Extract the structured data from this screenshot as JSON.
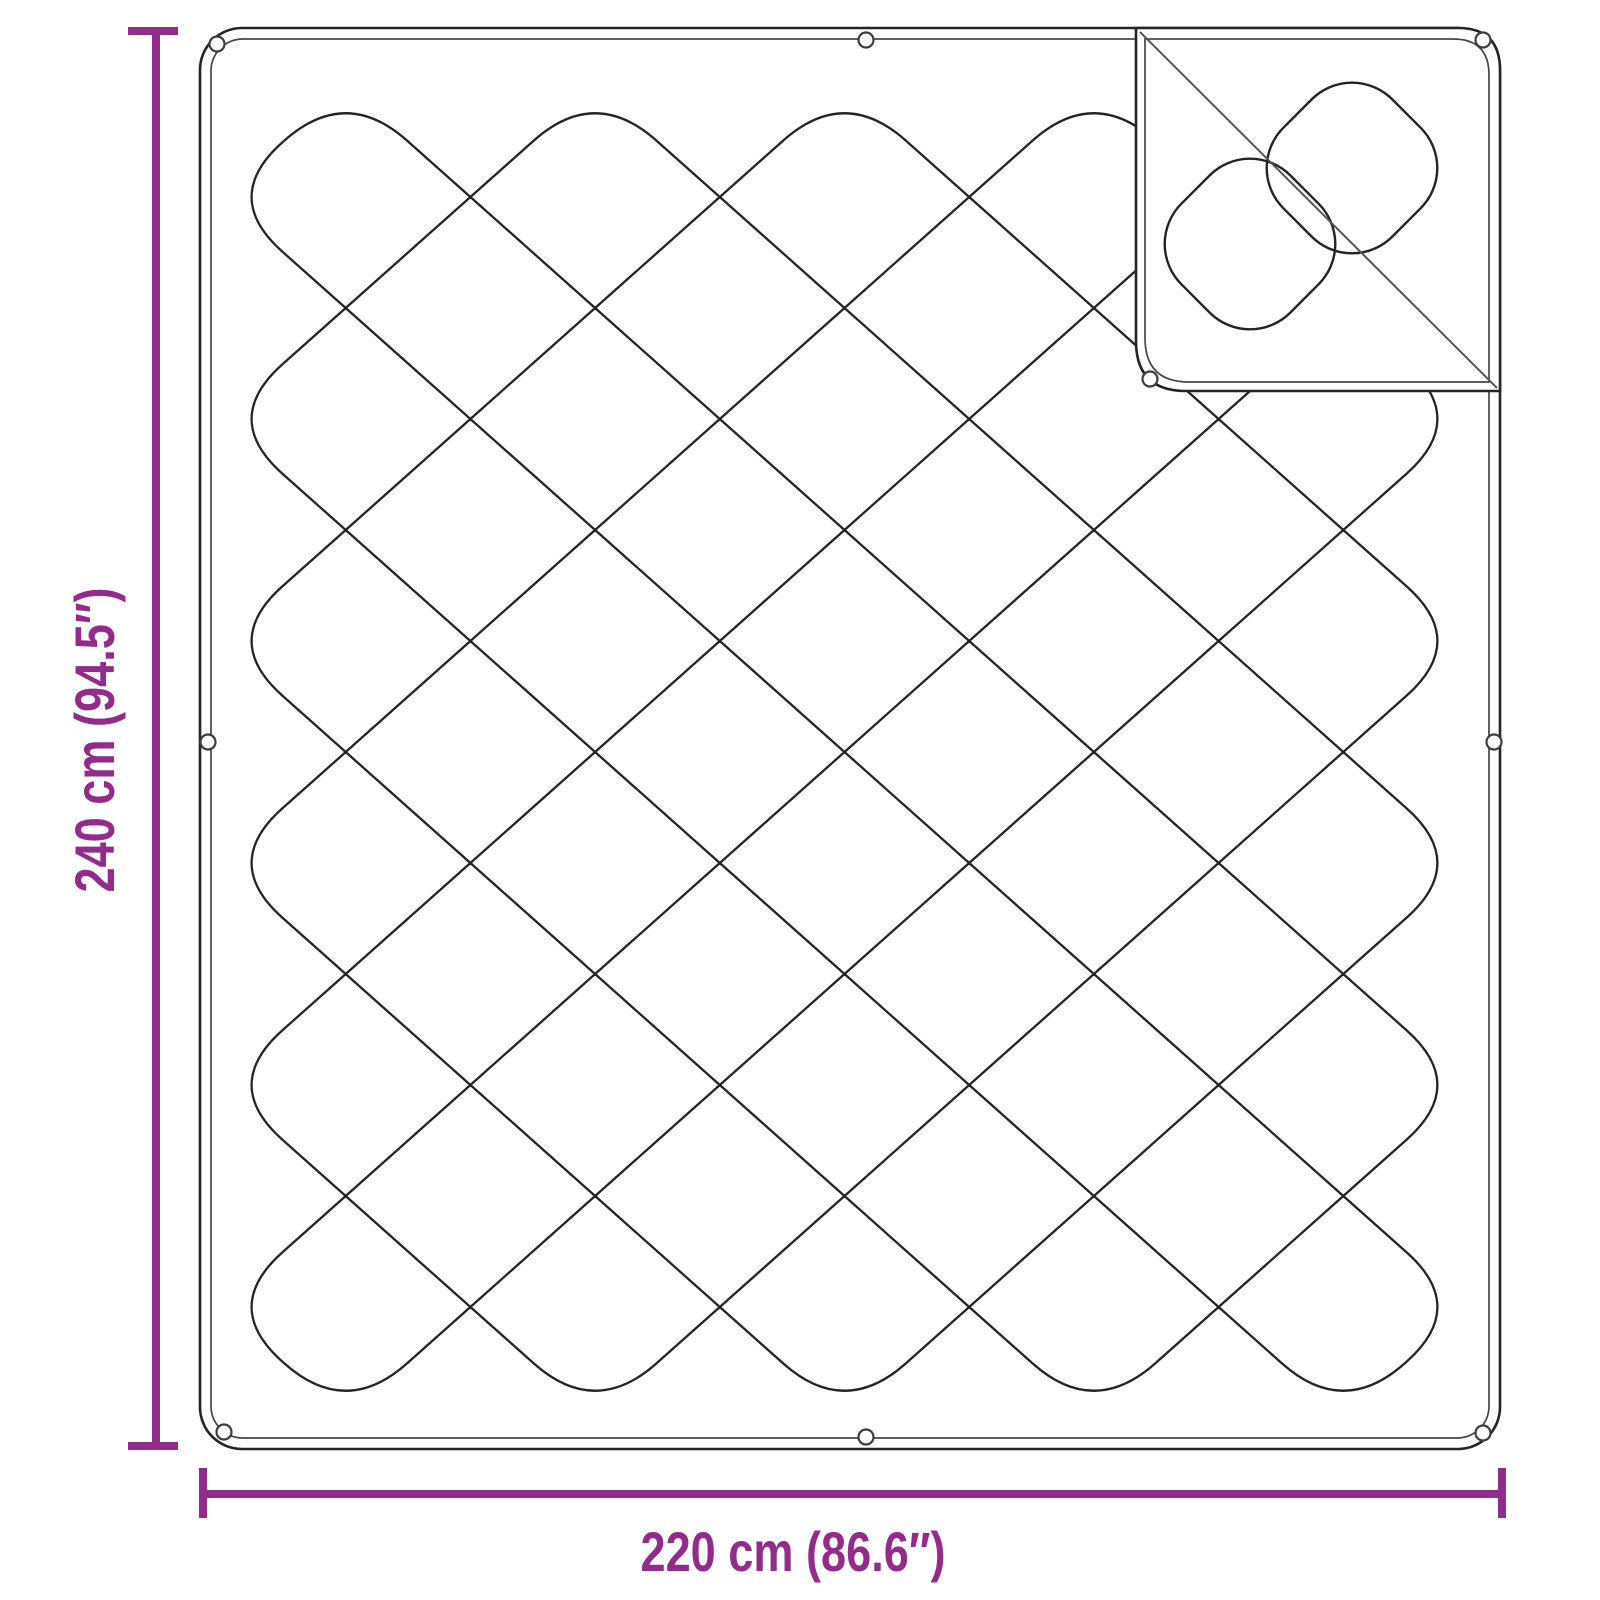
{
  "diagram": {
    "height_label": "240 cm (94.5″)",
    "width_label": "220 cm (86.6″)",
    "accent_color": "#932b8a",
    "line_color": "#242424"
  }
}
